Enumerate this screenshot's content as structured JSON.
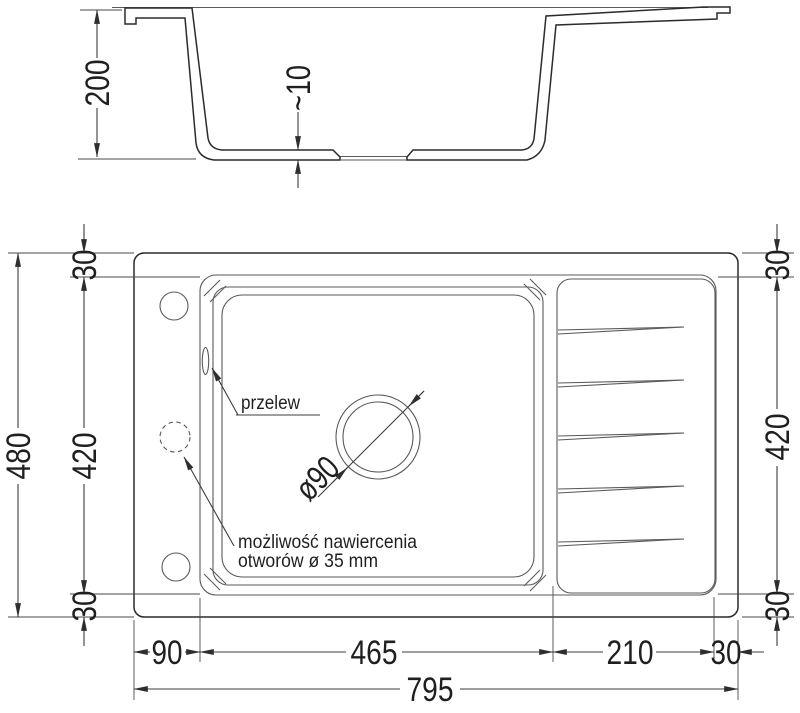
{
  "section": {
    "depth": "200",
    "bottom_thickness": "~10"
  },
  "plan": {
    "labels": {
      "overflow": "przelew",
      "drill_note_line1": "możliwość nawiercenia",
      "drill_note_line2": "otworów ø 35 mm",
      "drain_diameter": "ø90"
    },
    "dims": {
      "overall_length": "795",
      "overall_depth": "480",
      "inner_depth_left": "420",
      "inner_depth_right": "420",
      "border_top_left": "30",
      "border_bottom_left": "30",
      "border_top_right": "30",
      "border_bottom_right": "30",
      "border_right_end": "30",
      "left_offset": "90",
      "bowl_length": "465",
      "drainer_length": "210"
    }
  },
  "colors": {
    "line": "#2b2b2b",
    "hatch_line": "#7d7d7d",
    "hatch_fill": "#ececec",
    "background": "#ffffff"
  }
}
